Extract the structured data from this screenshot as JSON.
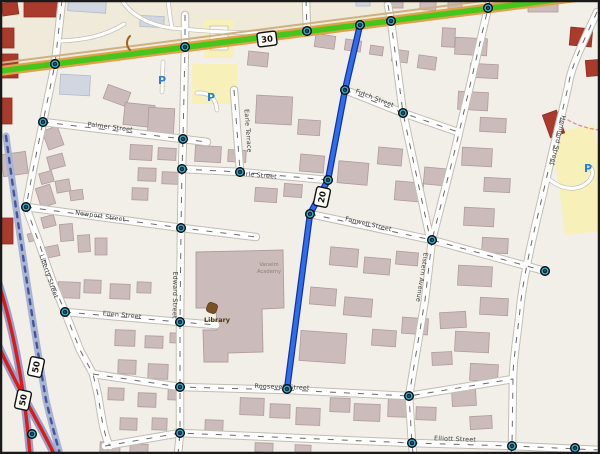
{
  "map_data": {
    "type": "map",
    "colors": {
      "bg": "#f2efe9",
      "khaki_top": "#efead9",
      "yellow_area": "#f8f0b9",
      "building_mauve": "#ccbbbb",
      "building_mauve_stroke": "#af9c9c",
      "building_gray": "#d2d6e0",
      "building_gray_stroke": "#b4bac8",
      "building_red": "#a93a2c",
      "building_red_stroke": "#8d2f24",
      "building_white": "#f9f9f4",
      "building_white_stroke": "#c0c0ba",
      "street_casing": "#c2beb4",
      "street_fill": "#ffffff",
      "street_dash": "#6b6b6b",
      "green_road": "#46c51a",
      "green_casing": "#dda24a",
      "green_parallel": "#cdb084",
      "blue_route": "#2d6ef0",
      "blue_route_casing": "#15339b",
      "railway": "#a9b4d4",
      "railway_dash": "#46549e",
      "red_road": "#e01818",
      "red_road_casing": "#93a2cc",
      "node_fill": "#0b2036",
      "node_ring": "#35b6cc",
      "label_text": "#3c3c3c",
      "library_text": "#4a3505",
      "academy_text": "#8b8174",
      "parking_blue": "#2a7fd4",
      "footpath_red": "#e88a8a",
      "border": "#1a1a1a",
      "shield_bg": "#fffef8"
    },
    "green_highway": {
      "d": "M 0,71 L 600,-6",
      "parallel_d": "M 0,63 L 600,-14",
      "ref": "30"
    },
    "blue_route": {
      "d": "M 360,25 L 345,90 L 328,180 L 310,214 L 287,389",
      "ref": "20"
    },
    "railway": {
      "d": "M 6,136 C 20,240 34,330 46,400 C 52,425 56,440 60,454"
    },
    "red_roads": [
      {
        "d": "M -6,270 C 12,320 24,385 30,454"
      },
      {
        "d": "M -6,336 C 18,390 40,424 54,454"
      }
    ],
    "footpath": {
      "d": "M 568,120 C 578,126 590,129 600,130"
    },
    "streets": [
      {
        "id": "liberty-street",
        "d": "M 62,0 L 55,64 L 43,122 L 33,170 L 26,207 L 38,240 L 53,283 L 65,312 L 80,350 L 93,374 L 98,395 C 102,420 104,436 110,446"
      },
      {
        "id": "edward-street",
        "d": "M 185,15 L 185,47 L 183,139 L 182,169 L 181,228 L 180,322 L 180,387 L 180,433 L 178,454"
      },
      {
        "id": "palmer-street",
        "d": "M 43,122 L 183,139 L 207,142"
      },
      {
        "id": "newport-street",
        "d": "M 26,207 L 182,228 L 256,237"
      },
      {
        "id": "ellen-street",
        "d": "M 65,312 L 180,322 L 216,325"
      },
      {
        "id": "roosevelt-street",
        "d": "M 93,374 L 180,387 L 287,390 L 409,396 L 513,379"
      },
      {
        "id": "elliott-street",
        "d": "M 105,446 L 180,433 L 412,443 L 512,446 L 600,450"
      },
      {
        "id": "earle-street",
        "d": "M 182,169 L 240,172 L 328,180"
      },
      {
        "id": "earle-terrace",
        "d": "M 234,90 L 240,171"
      },
      {
        "id": "futch-street",
        "d": "M 345,90 L 403,113 L 458,132"
      },
      {
        "id": "fanwell-street",
        "d": "M 310,214 L 432,240 L 545,271"
      },
      {
        "id": "north-stub-1",
        "d": "M 388,5 L 391,21 L 403,113 L 430,238"
      },
      {
        "id": "north-stub-2",
        "d": "M 490,0 L 488,8 L 455,150 L 432,240"
      },
      {
        "id": "elstern-avenue",
        "d": "M 432,240 L 425,300 L 409,396 L 412,443 L 413,454"
      },
      {
        "id": "hemford-street",
        "d": "M 597,12 C 583,42 571,68 569,82 C 565,102 555,140 547,176 C 539,212 527,256 521,300 C 517,340 513,360 513,378 L 512,446 L 511,454"
      },
      {
        "id": "top-stub-3",
        "d": "M 306,0 L 307,31"
      }
    ],
    "service_roads": [
      {
        "id": "lot-loop",
        "d": "M 122,0 C 130,14 148,25 172,28 C 218,33 262,34 305,32"
      },
      {
        "id": "lot-branch",
        "d": "M 172,28 C 170,18 169,8 168,0"
      },
      {
        "id": "lot-west",
        "d": "M 60,41 C 85,40 105,36 124,24"
      },
      {
        "id": "parking-drive",
        "d": "M 197,93 C 210,92 216,99 217,110"
      },
      {
        "id": "parking-spur",
        "d": "M 163,62 L 162,92"
      },
      {
        "id": "hemford-drive",
        "d": "M 550,180 C 564,191 579,191 589,181 C 594,175 593,170 590,167"
      }
    ],
    "street_labels": [
      {
        "text": "Palmer Street",
        "x": 110,
        "y": 129,
        "rot": 7
      },
      {
        "text": "Newport Street",
        "x": 100,
        "y": 218,
        "rot": 8
      },
      {
        "text": "Ellen Street",
        "x": 122,
        "y": 317,
        "rot": 5
      },
      {
        "text": "Edward Street",
        "x": 173,
        "y": 295,
        "rot": 91
      },
      {
        "text": "Liberty Street",
        "x": 47,
        "y": 277,
        "rot": 71
      },
      {
        "text": "Earle Terrace",
        "x": 246,
        "y": 131,
        "rot": 86
      },
      {
        "text": "Earle Street",
        "x": 257,
        "y": 177,
        "rot": 5
      },
      {
        "text": "Futch Street",
        "x": 374,
        "y": 100,
        "rot": 21
      },
      {
        "text": "Fanwell Street",
        "x": 368,
        "y": 226,
        "rot": 13
      },
      {
        "text": "Roosevelt Street",
        "x": 282,
        "y": 389,
        "rot": 2
      },
      {
        "text": "Elliott Street",
        "x": 455,
        "y": 441,
        "rot": 2
      },
      {
        "text": "Elstern Avenue",
        "x": 420,
        "y": 277,
        "rot": 99
      },
      {
        "text": "Hemford Street",
        "x": 556,
        "y": 140,
        "rot": 103
      }
    ],
    "route_markers": [
      {
        "ref": "30",
        "x": 267,
        "y": 39,
        "rot": -7
      },
      {
        "ref": "20",
        "x": 322,
        "y": 197,
        "rot": -78
      },
      {
        "ref": "50",
        "x": 36,
        "y": 367,
        "rot": -78
      },
      {
        "ref": "50",
        "x": 23,
        "y": 400,
        "rot": -78
      }
    ],
    "pois": {
      "library": {
        "label": "Library",
        "icon_x": 212,
        "icon_y": 308,
        "label_x": 217,
        "label_y": 322
      },
      "academy": {
        "lines": [
          "Vanelm",
          "Academy"
        ],
        "x": 269,
        "y": 266
      },
      "parking": [
        {
          "x": 162,
          "y": 80
        },
        {
          "x": 211,
          "y": 97
        },
        {
          "x": 588,
          "y": 168
        }
      ]
    },
    "khaki_polygon": "0,0 600,0 600,-8 0,66",
    "yellow_areas": [
      {
        "x": 204,
        "y": 20,
        "w": 30,
        "h": 38,
        "rot": 0
      },
      {
        "x": 192,
        "y": 64,
        "w": 45,
        "h": 40,
        "rot": 0
      },
      {
        "x": 558,
        "y": 128,
        "w": 44,
        "h": 105,
        "rot": -8
      }
    ],
    "library_complex": "M 196,252 L 283,250 L 284,308 L 262,309 L 263,352 L 228,353 L 228,362 L 204,362 L 203,330 L 217,330 L 216,308 L 196,308 Z",
    "nodes": [
      [
        55,
        64
      ],
      [
        185,
        47
      ],
      [
        307,
        31
      ],
      [
        360,
        25
      ],
      [
        391,
        21
      ],
      [
        488,
        8
      ],
      [
        43,
        122
      ],
      [
        26,
        207
      ],
      [
        65,
        312
      ],
      [
        183,
        139
      ],
      [
        182,
        169
      ],
      [
        181,
        228
      ],
      [
        180,
        322
      ],
      [
        180,
        387
      ],
      [
        180,
        433
      ],
      [
        240,
        172
      ],
      [
        328,
        180
      ],
      [
        345,
        90
      ],
      [
        310,
        214
      ],
      [
        287,
        389
      ],
      [
        403,
        113
      ],
      [
        432,
        240
      ],
      [
        409,
        396
      ],
      [
        412,
        443
      ],
      [
        512,
        446
      ],
      [
        545,
        271
      ],
      [
        575,
        448
      ],
      [
        32,
        434
      ]
    ],
    "buildings": [
      [
        2,
        2,
        16,
        13,
        -8,
        "r"
      ],
      [
        24,
        0,
        36,
        17,
        0,
        "r"
      ],
      [
        0,
        28,
        14,
        20,
        0,
        "r"
      ],
      [
        0,
        54,
        18,
        24,
        0,
        "r"
      ],
      [
        0,
        98,
        12,
        26,
        0,
        "r"
      ],
      [
        68,
        0,
        38,
        12,
        4,
        "g"
      ],
      [
        140,
        16,
        24,
        11,
        3,
        "g"
      ],
      [
        210,
        26,
        18,
        24,
        0,
        "w"
      ],
      [
        356,
        0,
        14,
        6,
        0,
        "g"
      ],
      [
        385,
        0,
        18,
        8,
        0,
        "m"
      ],
      [
        420,
        0,
        16,
        10,
        3,
        "m"
      ],
      [
        448,
        0,
        14,
        12,
        0,
        "m"
      ],
      [
        528,
        0,
        30,
        12,
        0,
        "m"
      ],
      [
        570,
        28,
        22,
        18,
        5,
        "r"
      ],
      [
        586,
        60,
        14,
        16,
        -5,
        "r"
      ],
      [
        546,
        112,
        15,
        24,
        -20,
        "r"
      ],
      [
        60,
        75,
        30,
        20,
        3,
        "g"
      ],
      [
        105,
        88,
        24,
        15,
        20,
        "m"
      ],
      [
        124,
        104,
        30,
        22,
        6,
        "m"
      ],
      [
        148,
        108,
        26,
        30,
        3,
        "m"
      ],
      [
        45,
        128,
        16,
        20,
        -20,
        "m"
      ],
      [
        48,
        155,
        16,
        13,
        -15,
        "m"
      ],
      [
        40,
        172,
        13,
        11,
        -15,
        "m"
      ],
      [
        56,
        180,
        14,
        12,
        -10,
        "m"
      ],
      [
        70,
        190,
        13,
        10,
        -8,
        "m"
      ],
      [
        130,
        145,
        22,
        15,
        3,
        "m"
      ],
      [
        158,
        148,
        18,
        12,
        3,
        "m"
      ],
      [
        138,
        168,
        18,
        13,
        2,
        "m"
      ],
      [
        162,
        172,
        16,
        12,
        2,
        "m"
      ],
      [
        132,
        188,
        16,
        12,
        2,
        "m"
      ],
      [
        2,
        153,
        25,
        22,
        -8,
        "m"
      ],
      [
        0,
        218,
        13,
        26,
        0,
        "r"
      ],
      [
        38,
        186,
        15,
        20,
        -18,
        "m"
      ],
      [
        42,
        216,
        13,
        11,
        -15,
        "m"
      ],
      [
        28,
        233,
        9,
        8,
        -15,
        "m"
      ],
      [
        60,
        224,
        13,
        17,
        -5,
        "m"
      ],
      [
        78,
        235,
        12,
        17,
        -3,
        "m"
      ],
      [
        95,
        238,
        12,
        17,
        0,
        "m"
      ],
      [
        45,
        246,
        14,
        11,
        -12,
        "m"
      ],
      [
        58,
        282,
        22,
        16,
        2,
        "m"
      ],
      [
        84,
        280,
        17,
        13,
        2,
        "m"
      ],
      [
        110,
        284,
        20,
        15,
        2,
        "m"
      ],
      [
        137,
        282,
        14,
        11,
        2,
        "m"
      ],
      [
        195,
        146,
        26,
        16,
        3,
        "m"
      ],
      [
        228,
        150,
        18,
        12,
        3,
        "m"
      ],
      [
        256,
        96,
        36,
        28,
        3,
        "m"
      ],
      [
        298,
        120,
        22,
        15,
        4,
        "m"
      ],
      [
        255,
        188,
        22,
        14,
        4,
        "m"
      ],
      [
        284,
        184,
        18,
        13,
        4,
        "m"
      ],
      [
        300,
        155,
        24,
        17,
        5,
        "m"
      ],
      [
        338,
        162,
        30,
        22,
        5,
        "m"
      ],
      [
        378,
        148,
        24,
        17,
        5,
        "m"
      ],
      [
        395,
        182,
        28,
        19,
        5,
        "m"
      ],
      [
        424,
        168,
        24,
        17,
        5,
        "m"
      ],
      [
        248,
        52,
        20,
        14,
        6,
        "m"
      ],
      [
        315,
        35,
        20,
        13,
        8,
        "m"
      ],
      [
        345,
        40,
        16,
        11,
        8,
        "m"
      ],
      [
        370,
        46,
        13,
        9,
        8,
        "m"
      ],
      [
        392,
        50,
        16,
        12,
        8,
        "m"
      ],
      [
        418,
        56,
        18,
        13,
        8,
        "m"
      ],
      [
        442,
        28,
        13,
        19,
        3,
        "m"
      ],
      [
        455,
        38,
        32,
        17,
        3,
        "m"
      ],
      [
        470,
        64,
        28,
        14,
        3,
        "m"
      ],
      [
        458,
        92,
        30,
        18,
        3,
        "m"
      ],
      [
        480,
        118,
        26,
        14,
        3,
        "m"
      ],
      [
        462,
        148,
        30,
        18,
        3,
        "m"
      ],
      [
        484,
        178,
        26,
        14,
        3,
        "m"
      ],
      [
        464,
        208,
        30,
        18,
        3,
        "m"
      ],
      [
        482,
        238,
        26,
        15,
        3,
        "m"
      ],
      [
        458,
        266,
        34,
        20,
        3,
        "m"
      ],
      [
        480,
        298,
        28,
        17,
        3,
        "m"
      ],
      [
        455,
        332,
        34,
        20,
        3,
        "m"
      ],
      [
        470,
        364,
        28,
        17,
        3,
        "m"
      ],
      [
        330,
        248,
        28,
        18,
        5,
        "m"
      ],
      [
        364,
        258,
        26,
        16,
        5,
        "m"
      ],
      [
        396,
        252,
        22,
        13,
        5,
        "m"
      ],
      [
        310,
        288,
        26,
        17,
        5,
        "m"
      ],
      [
        344,
        298,
        28,
        18,
        5,
        "m"
      ],
      [
        300,
        332,
        46,
        30,
        4,
        "m"
      ],
      [
        372,
        330,
        24,
        16,
        4,
        "m"
      ],
      [
        402,
        318,
        26,
        16,
        4,
        "m"
      ],
      [
        115,
        330,
        20,
        16,
        2,
        "m"
      ],
      [
        145,
        336,
        18,
        12,
        2,
        "m"
      ],
      [
        170,
        333,
        13,
        10,
        2,
        "m"
      ],
      [
        118,
        360,
        18,
        14,
        2,
        "m"
      ],
      [
        148,
        364,
        20,
        15,
        2,
        "m"
      ],
      [
        108,
        388,
        16,
        12,
        2,
        "m"
      ],
      [
        138,
        393,
        18,
        14,
        2,
        "m"
      ],
      [
        168,
        388,
        13,
        12,
        2,
        "m"
      ],
      [
        120,
        418,
        17,
        12,
        2,
        "m"
      ],
      [
        152,
        418,
        15,
        12,
        2,
        "m"
      ],
      [
        100,
        442,
        20,
        11,
        2,
        "m"
      ],
      [
        130,
        444,
        18,
        9,
        2,
        "m"
      ],
      [
        240,
        398,
        24,
        17,
        2,
        "m"
      ],
      [
        270,
        404,
        20,
        14,
        2,
        "m"
      ],
      [
        296,
        408,
        24,
        17,
        2,
        "m"
      ],
      [
        330,
        398,
        20,
        14,
        2,
        "m"
      ],
      [
        354,
        404,
        26,
        17,
        2,
        "m"
      ],
      [
        388,
        398,
        24,
        19,
        2,
        "m"
      ],
      [
        416,
        407,
        20,
        13,
        2,
        "m"
      ],
      [
        205,
        420,
        18,
        12,
        2,
        "m"
      ],
      [
        255,
        443,
        18,
        9,
        2,
        "m"
      ],
      [
        295,
        445,
        16,
        8,
        2,
        "m"
      ],
      [
        440,
        312,
        26,
        16,
        -3,
        "m"
      ],
      [
        432,
        352,
        20,
        13,
        -3,
        "m"
      ],
      [
        452,
        390,
        24,
        16,
        -3,
        "m"
      ],
      [
        470,
        416,
        22,
        13,
        -3,
        "m"
      ]
    ],
    "misc": {
      "gate_arc": "M 130,36 C 126,40 126,46 130,50"
    }
  }
}
